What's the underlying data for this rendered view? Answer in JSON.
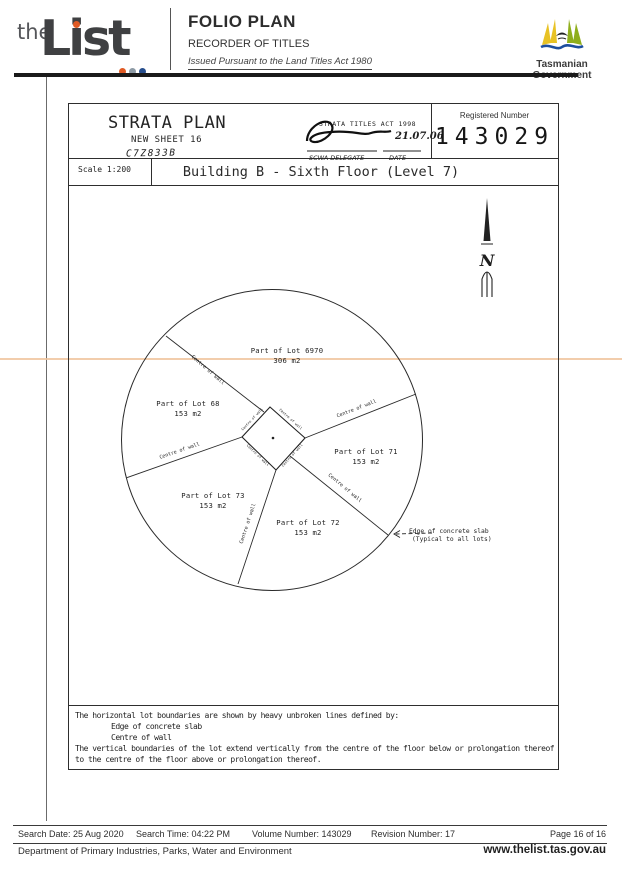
{
  "header": {
    "logo_the": "the",
    "logo_list": "List",
    "logo_dot_colors": [
      "#e05a24",
      "#8d9aa5",
      "#274e8d"
    ],
    "folio_title": "FOLIO PLAN",
    "folio_subtitle": "RECORDER OF TITLES",
    "folio_issued": "Issued Pursuant to the Land Titles Act 1980",
    "gov_name_line1": "Tasmanian",
    "gov_name_line2": "Government"
  },
  "plan_header": {
    "strata_title": "STRATA PLAN",
    "sheet": "NEW SHEET 16",
    "handwritten_ref": "C7Z833B",
    "stamp_act": "STRATA TITLES ACT 1998",
    "stamp_date": "21.07.06",
    "stamp_delegate": "SCWA DELEGATE",
    "stamp_date_label": "DATE",
    "registered_number_label": "Registered Number",
    "registered_number": "143029"
  },
  "title_bar": {
    "scale": "Scale 1:200",
    "title": "Building B - Sixth Floor (Level 7)"
  },
  "compass": {
    "letter": "N"
  },
  "plan": {
    "lots": [
      {
        "name": "Part of Lot 6970",
        "area": "306 m2"
      },
      {
        "name": "Part of Lot 68",
        "area": "153 m2"
      },
      {
        "name": "Part of Lot 71",
        "area": "153 m2"
      },
      {
        "name": "Part of Lot 73",
        "area": "153 m2"
      },
      {
        "name": "Part of Lot 72",
        "area": "153 m2"
      }
    ],
    "wall_label": "Centre of wall",
    "edge_note_line1": "Edge of concrete slab",
    "edge_note_line2": "(Typical to all lots)"
  },
  "notes": {
    "line1": "The horizontal lot boundaries are shown by heavy unbroken lines defined by:",
    "line2": "Edge of concrete slab",
    "line3": "Centre of wall",
    "line4": "The vertical boundaries of the lot extend vertically from the centre of the floor below or prolongation thereof",
    "line5": "to the centre of the floor above or prolongation thereof."
  },
  "footer": {
    "search_date": "Search Date: 25 Aug 2020",
    "search_time": "Search Time: 04:22 PM",
    "volume_number": "Volume Number: 143029",
    "revision_number": "Revision Number: 17",
    "page": "Page 16 of 16",
    "department": "Department of Primary Industries, Parks, Water and Environment",
    "website": "www.thelist.tas.gov.au"
  },
  "artifacts": {
    "scan_line_color": "#f0c49e"
  }
}
